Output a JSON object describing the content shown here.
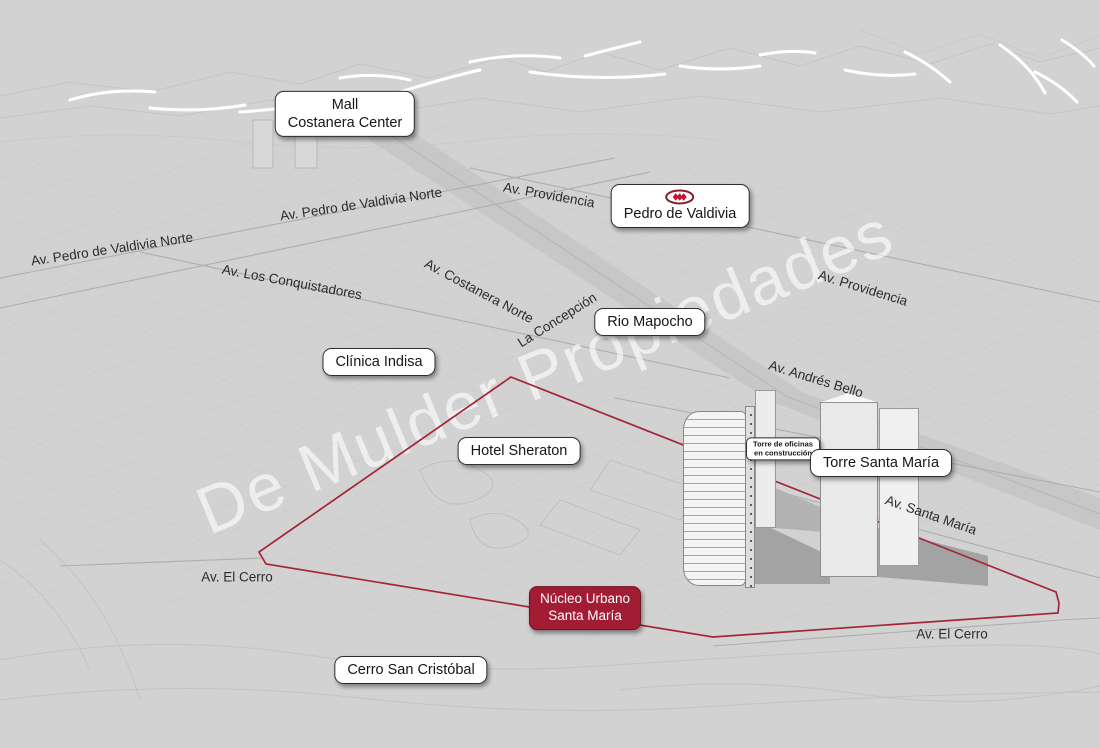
{
  "watermark": "De Mulder Propiedades",
  "colors": {
    "background": "#d2d2d2",
    "polygon_red": "#a32638",
    "nucleo_box_bg": "#a21c33",
    "nucleo_box_border": "#6f1120",
    "metro_red": "#c8102e",
    "metro_oval": "#8b1a28",
    "callout_border": "#2e2e2e"
  },
  "icons": {
    "metro_logo": "santiago-metro-three-diamonds-oval"
  },
  "callouts": {
    "mall": {
      "line1": "Mall",
      "line2": "Costanera Center"
    },
    "metro_station": {
      "label": "Pedro de Valdivia"
    },
    "rio": {
      "label": "Rio Mapocho"
    },
    "clinica": {
      "label": "Clínica Indisa"
    },
    "hotel": {
      "label": "Hotel Sheraton"
    },
    "torre_oficinas": {
      "line1": "Torre de oficinas",
      "line2": "en construcción"
    },
    "torre_santa_maria": {
      "label": "Torre Santa María"
    },
    "nucleo": {
      "line1": "Núcleo Urbano",
      "line2": "Santa María"
    },
    "cerro_san_cristobal": {
      "label": "Cerro San Cristóbal"
    }
  },
  "streets": {
    "pedro_valdivia_norte_1": "Av. Pedro de Valdivia Norte",
    "pedro_valdivia_norte_2": "Av. Pedro de Valdivia Norte",
    "providencia_top": "Av. Providencia",
    "los_conquistadores": "Av. Los Conquistadores",
    "costanera_norte": "Av. Costanera Norte",
    "la_concepcion": "La Concepción",
    "andres_bello": "Av. Andrés Bello",
    "providencia_right": "Av. Providencia",
    "santa_maria": "Av. Santa María",
    "el_cerro_left": "Av. El Cerro",
    "el_cerro_right": "Av. El Cerro"
  }
}
